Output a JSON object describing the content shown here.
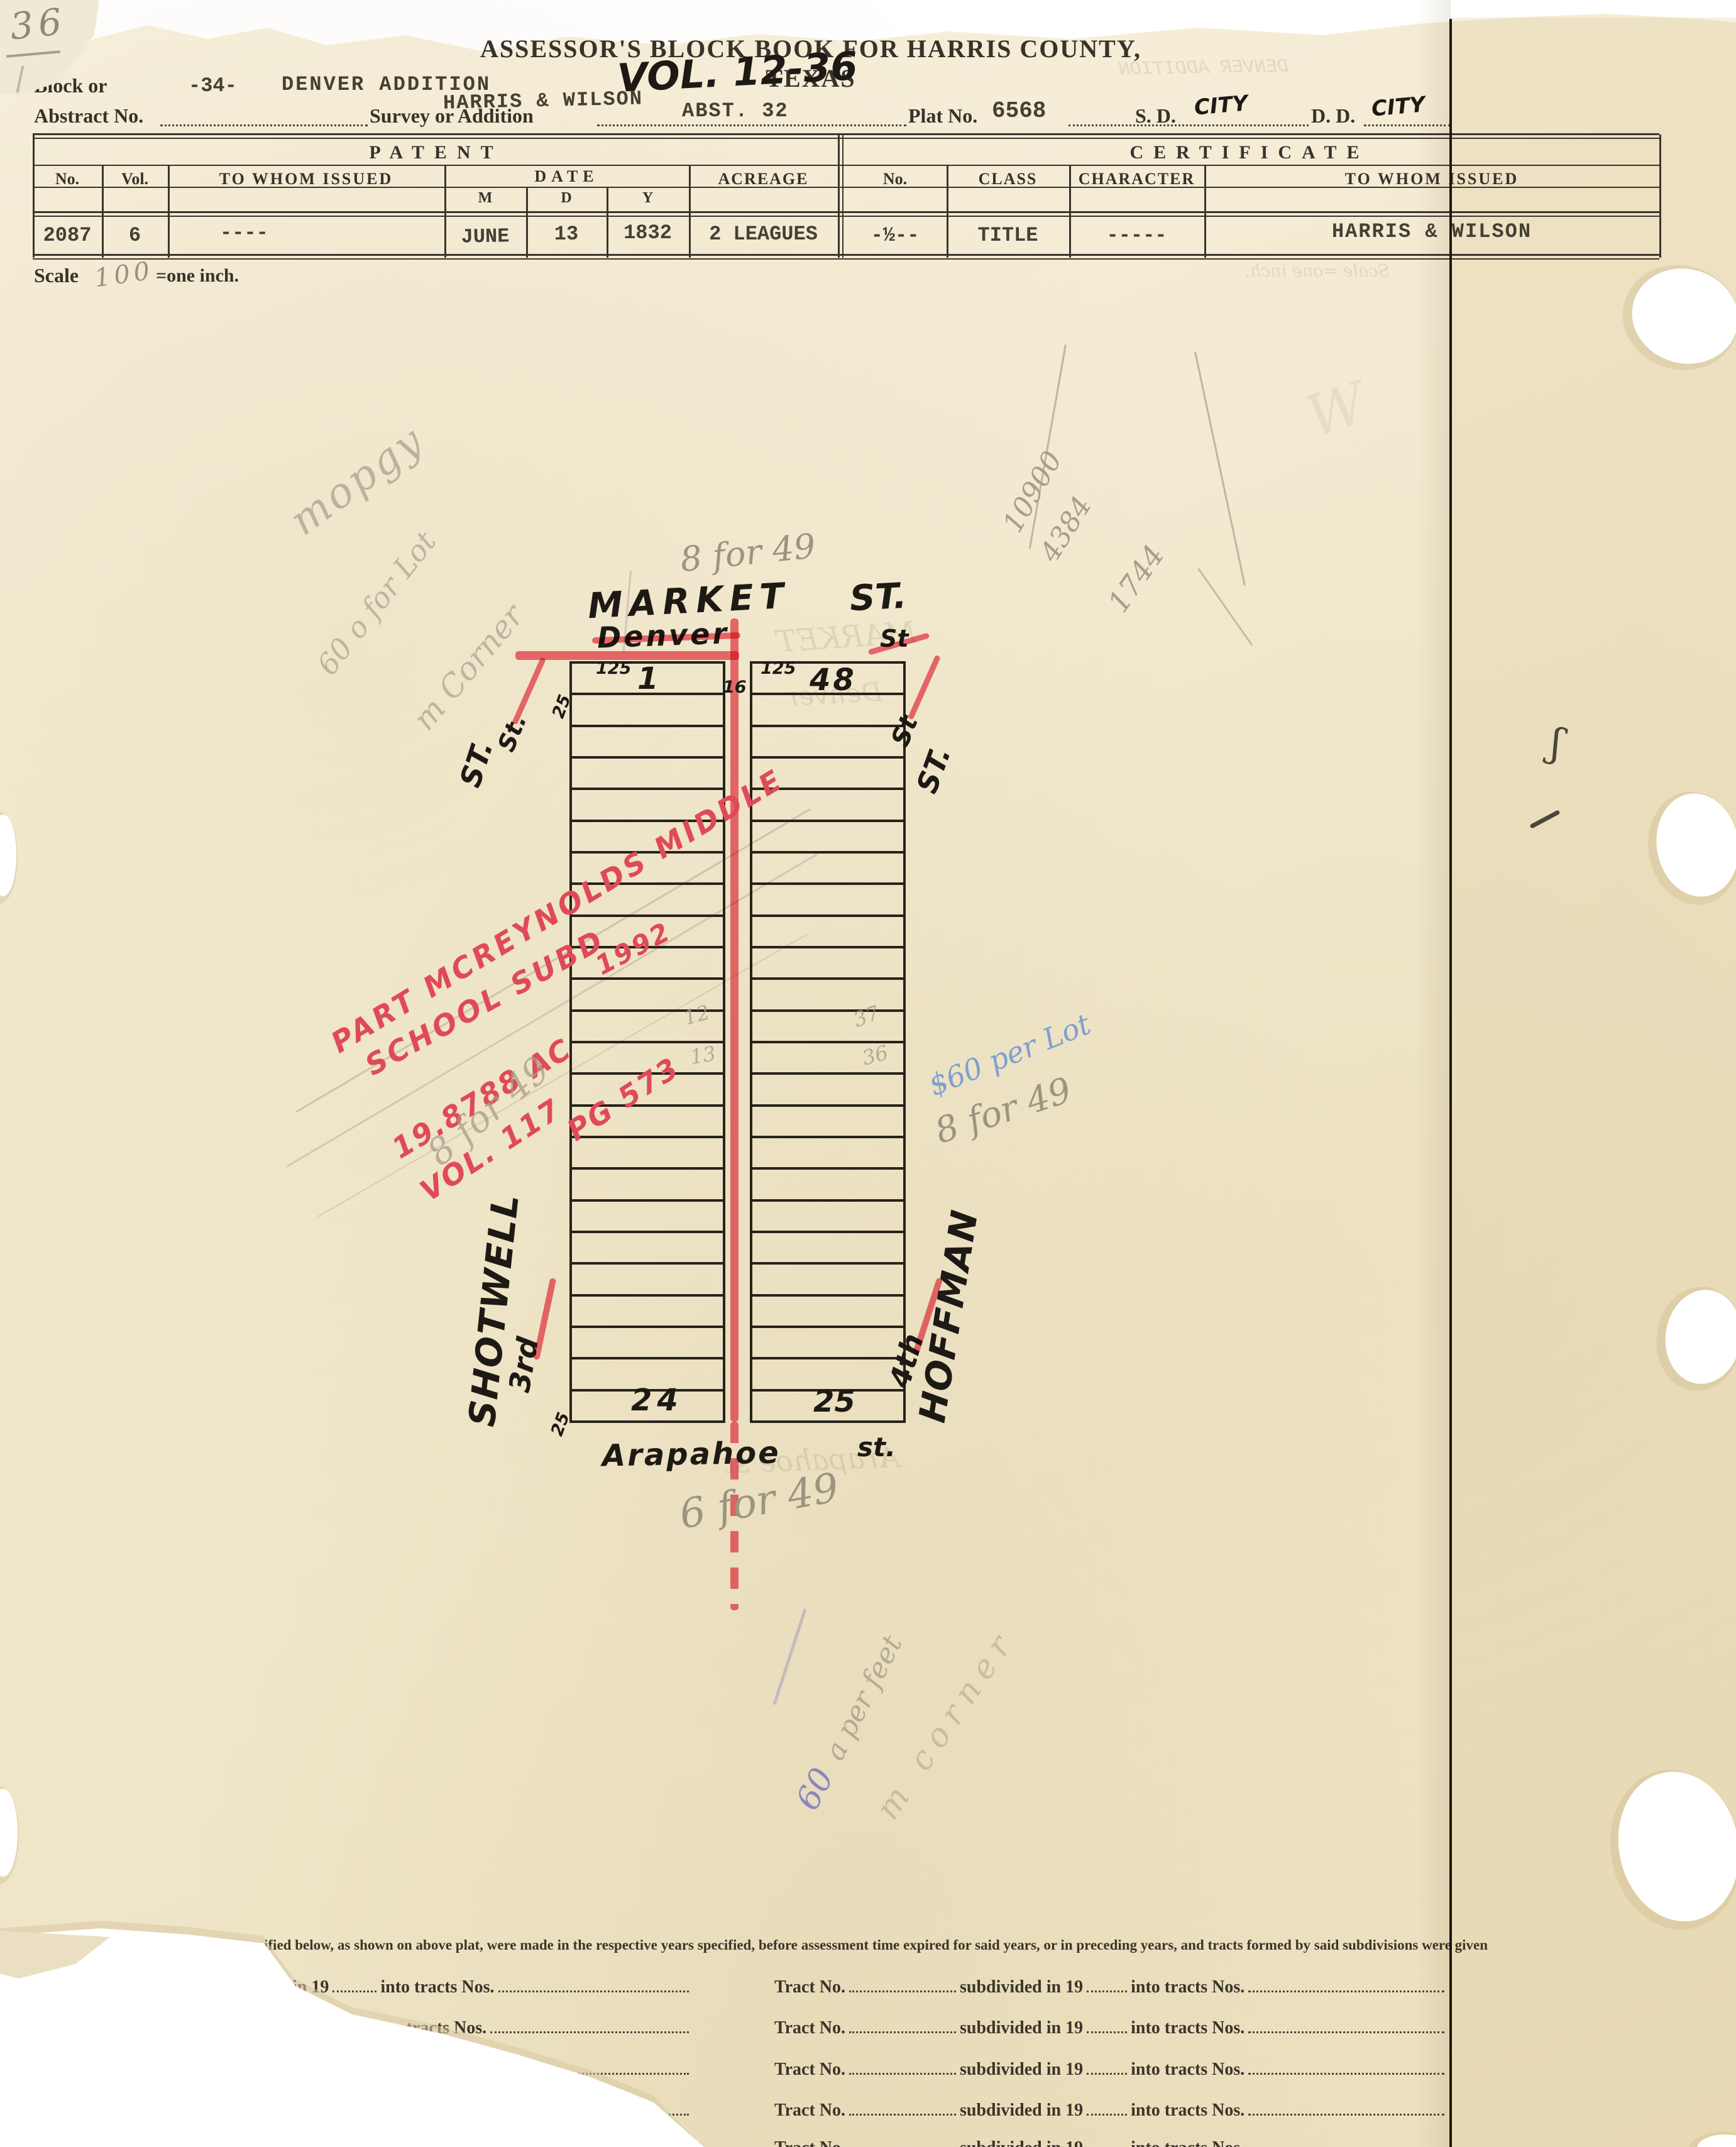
{
  "page": {
    "pencil_number": "36"
  },
  "colors": {
    "red": "#e8515e",
    "pencil": "#a79d8a",
    "blue_pencil": "#7f9fd0",
    "ink": "#211f1a",
    "paper": "#f2ead0"
  },
  "header": {
    "title": "ASSESSOR'S BLOCK BOOK FOR HARRIS COUNTY, TEXAS",
    "volume_note": "VOL. 12-36",
    "block_label": "Block or",
    "block_value": "-34-",
    "addition_value": "DENVER ADDITION",
    "abstract_label": "Abstract No.",
    "survey_label": "Survey or Addition",
    "survey_value": "HARRIS & WILSON",
    "abstract_value": "ABST. 32",
    "plat_label": "Plat No.",
    "plat_value": "6568",
    "sd_label": "S. D.",
    "sd_value": "CITY",
    "dd_label": "D. D.",
    "dd_value": "CITY"
  },
  "patent": {
    "section_title": "PATENT",
    "col_no": "No.",
    "col_vol": "Vol.",
    "col_to_whom": "TO WHOM ISSUED",
    "col_date": "DATE",
    "col_m": "M",
    "col_d": "D",
    "col_y": "Y",
    "col_acreage": "ACREAGE",
    "no": "2087",
    "vol": "6",
    "to_whom": "----",
    "month": "JUNE",
    "day": "13",
    "year": "1832",
    "acreage": "2 LEAGUES"
  },
  "certificate": {
    "section_title": "CERTIFICATE",
    "col_no": "No.",
    "col_class": "CLASS",
    "col_character": "CHARACTER",
    "col_to_whom": "TO WHOM ISSUED",
    "no": "-½--",
    "class": "TITLE",
    "character": "-----",
    "to_whom": "HARRIS & WILSON"
  },
  "scale": {
    "label": "Scale",
    "value": "100",
    "suffix": "=one inch."
  },
  "plat": {
    "rows_per_column": 24,
    "market": "MARKET",
    "market_st": "ST.",
    "denver": "Denver",
    "denver_st": "St",
    "st_left_black": "ST.",
    "st_left_red": "St.",
    "st_right_red": "St",
    "st_right_black": "ST.",
    "shotwell": "SHOTWELL",
    "third": "3rd",
    "fourth": "4th",
    "hoffman": "HOFFMAN",
    "arapahoe": "Arapahoe",
    "arapahoe_st": "st.",
    "lot_top_left": "1",
    "lot_top_right": "48",
    "lot_bottom_left": "24",
    "lot_bottom_right": "25",
    "dim_125_left": "125",
    "dim_125_right": "125",
    "dim_25_top": "25",
    "dim_25_bottom": "25",
    "dim_16": "16",
    "cell_12": "12",
    "cell_13": "13",
    "cell_37": "37",
    "cell_36": "36"
  },
  "red_note": {
    "line1": "PART MCREYNOLDS MIDDLE",
    "line2": "SCHOOL   SUBD",
    "year": "1992",
    "line3": "19.8788 AC",
    "line4a": "VOL. 117",
    "line4b": "PG 573"
  },
  "pencil_notes": {
    "top_8for49": "8 for 49",
    "mid_8for49": "8 for 49",
    "blue_60perlot": "$60 per Lot",
    "right_8for49": "8 for 49",
    "bottom_6for49": "6 for 49",
    "scribble1": "mopgy",
    "scribble2": "60 o for Lot",
    "scribble3": "m Corner",
    "num1": "10900",
    "num2": "4384",
    "num3": "1744",
    "blue_60": "60",
    "per_feet": "a per feet",
    "corner_scribble": "m corner"
  },
  "ghosts": {
    "addition": "DENVER ADDITION",
    "market": "MARKET",
    "denver": "Denver",
    "arapahoe": "Arapahoe  st",
    "scale_line": "Scale  =one inch."
  },
  "form": {
    "paragraph": "ified below, as shown on above plat, were made in the respective years specified, before assessment time expired for said years, or in preceding years, and tracts formed by said subdivisions were given",
    "left_rows": [
      {
        "prefix": "ed in 19",
        "into": "into tracts Nos."
      },
      {
        "prefix": "d in 19",
        "into": "into tracts Nos."
      },
      {
        "prefix": "",
        "into": "into tracts Nos."
      },
      {
        "prefix": "",
        "into": "into tracts Nos."
      },
      {
        "prefix": "",
        "into": "into tracts Nos."
      }
    ],
    "right_rows": [
      {
        "tract": "Tract No.",
        "sub": "subdivided in 19",
        "into": "into tracts Nos."
      },
      {
        "tract": "Tract No.",
        "sub": "subdivided in 19",
        "into": "into tracts Nos."
      },
      {
        "tract": "Tract No.",
        "sub": "subdivided in 19",
        "into": "into tracts Nos."
      },
      {
        "tract": "Tract No.",
        "sub": "subdivided in 19",
        "into": "into tracts Nos."
      },
      {
        "tract": "Tract No.",
        "sub": "subdivided in 19",
        "into": "into tracts Nos."
      }
    ]
  }
}
